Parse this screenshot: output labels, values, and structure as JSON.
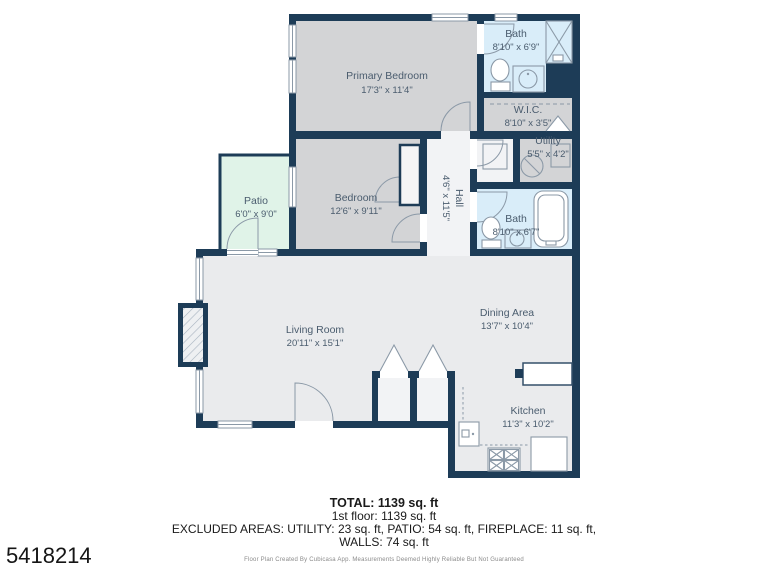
{
  "id_number": "5418214",
  "rooms": {
    "primary_bedroom": {
      "name": "Primary Bedroom",
      "dims": "17'3\" x 11'4\""
    },
    "bath_top": {
      "name": "Bath",
      "dims": "8'10\" x 6'9\""
    },
    "wic": {
      "name": "W.I.C.",
      "dims": "8'10\" x 3'5\""
    },
    "utility": {
      "name": "Utility",
      "dims": "5'5\" x 4'2\""
    },
    "bath_mid": {
      "name": "Bath",
      "dims": "8'10\" x 6'7\""
    },
    "hall": {
      "name": "Hall",
      "dims": "4'6\" x 11'5\""
    },
    "patio": {
      "name": "Patio",
      "dims": "6'0\" x 9'0\""
    },
    "bedroom": {
      "name": "Bedroom",
      "dims": "12'6\" x 9'11\""
    },
    "living_room": {
      "name": "Living Room",
      "dims": "20'11\" x 15'1\""
    },
    "dining_area": {
      "name": "Dining Area",
      "dims": "13'7\" x 10'4\""
    },
    "kitchen": {
      "name": "Kitchen",
      "dims": "11'3\" x 10'2\""
    }
  },
  "summary": {
    "total": "TOTAL: 1139 sq. ft",
    "floor": "1st floor: 1139 sq. ft",
    "excluded": "EXCLUDED AREAS: UTILITY: 23 sq. ft, PATIO: 54 sq. ft, FIREPLACE: 11 sq. ft,",
    "walls": "WALLS: 74 sq. ft",
    "disclaimer": "Floor Plan Created By Cubicasa App. Measurements Deemed Highly Reliable But Not Guaranteed"
  },
  "palette": {
    "wall": "#1d3c57",
    "floor_gray": "#d3d4d6",
    "floor_bath": "#d9edf9",
    "floor_patio": "#e0f3e8",
    "floor_main": "#eaebed",
    "floor_hall": "#f2f3f5",
    "fixture": "#8b99a7",
    "label": "#4a5c6e",
    "text": "#1a1a1a"
  }
}
